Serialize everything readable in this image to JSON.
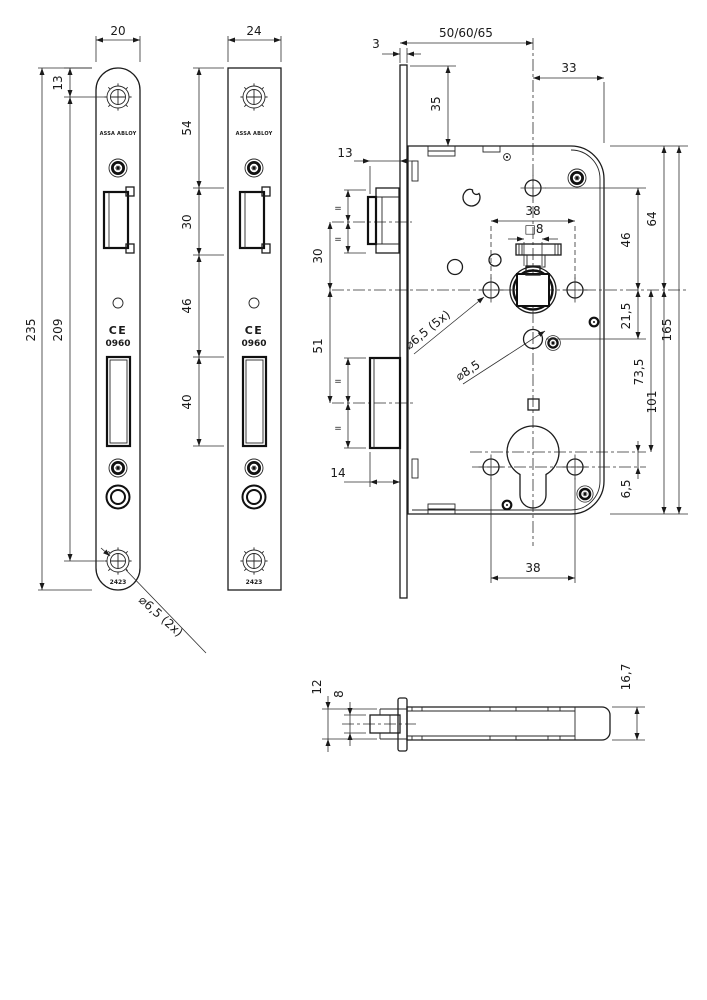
{
  "brand": {
    "name": "ASSA ABLOY",
    "ce": "CE",
    "ce_number": "0960",
    "model": "2423"
  },
  "dims": {
    "front_plate_round": {
      "width": "20",
      "top_to_screw": "13",
      "length": "235",
      "screw_span": "209",
      "screw_holes": "⌀0̶",
      "screw_holes_note": "⌀6,5 (2x)"
    },
    "front_plate_square": {
      "width": "24",
      "top_to_latch": "54",
      "latch_height": "30",
      "latch_to_bolt": "46",
      "bolt_height": "40"
    },
    "lock_case": {
      "backset": "50/60/65",
      "faceplate_thickness": "3",
      "plate_top_to_case": "35",
      "case_depth": "33",
      "latch_protrusion": "13",
      "screw_spacing": "38",
      "spindle_square": "□8",
      "latch_to_follower": "30",
      "follower_to_bolt": "51",
      "bolt_protrusion": "14",
      "screw_holes_note": "⌀6,5 (5x)",
      "hole_dia": "⌀8,5",
      "case_top_to_follower": "64",
      "hole_to_follower": "46",
      "follower_to_hole": "21,5",
      "case_height": "165",
      "follower_to_cylinder": "73,5",
      "follower_to_case_bottom": "101",
      "cylinder_to_screws": "6,5",
      "bottom_screw_spacing": "38",
      "equal": "="
    },
    "side_view": {
      "latch_head": "12",
      "latch_tip": "8",
      "case_thickness": "16,7"
    }
  }
}
